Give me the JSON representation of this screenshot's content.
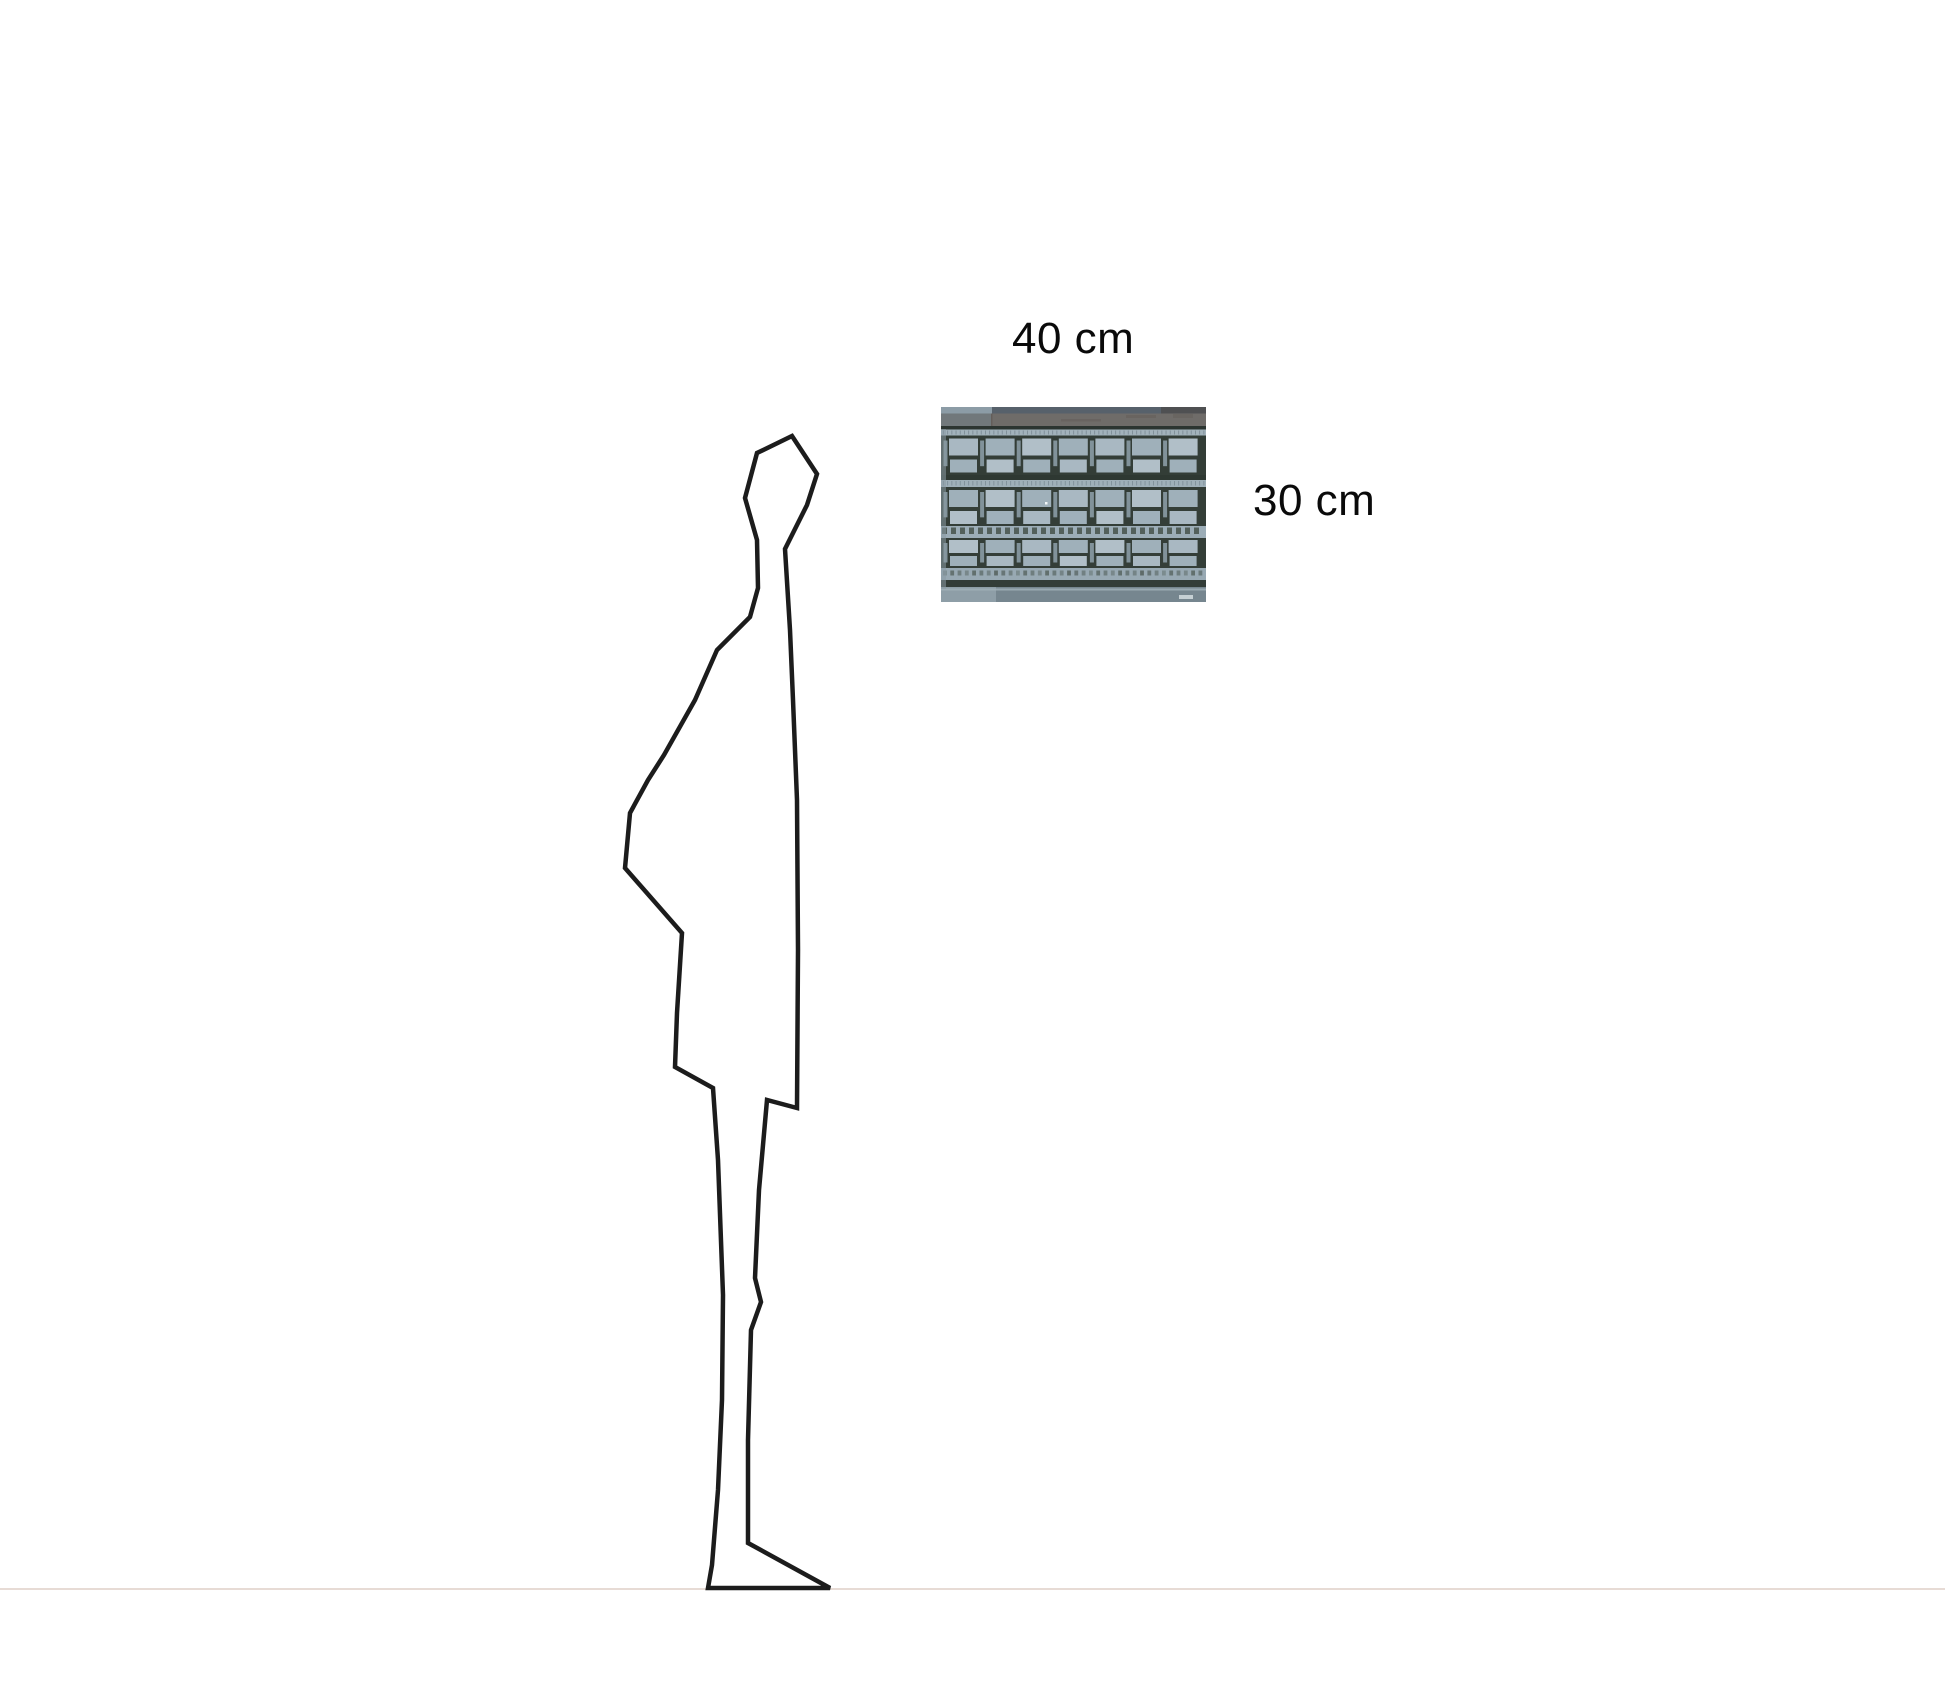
{
  "page": {
    "background_color": "#ffffff"
  },
  "scale_diagram": {
    "width_label": "40 cm",
    "height_label": "30 cm",
    "label_color": "#0a0a0a",
    "figure_outline_color": "#1c1c1c",
    "ground_line_color": "#e7dbd5",
    "artwork": {
      "alt": "aerial photograph of a modernist building facade with three rows of pale blue windows",
      "palette": {
        "facade_dark": "#333d37",
        "facade_dark2": "#343e38",
        "window_light": "#a9b8c2",
        "window_mid": "#9fb0ba",
        "window_bright": "#b1bfc8",
        "window_strip": "#8fa1ac",
        "cornice_light": "#a2b2bb",
        "cornice_light2": "#9fb0b9",
        "cornice_tick": "#6f7f88",
        "roof_gray": "#71787b",
        "roof_warm": "#6f6c69",
        "roof_streak": "#645e5a",
        "stripe_dark": "#2c3531",
        "stripe_dark2": "#2e3832",
        "stripe_dark3": "#333d38",
        "band_blue": "#9cadb7",
        "band_blue2": "#98a9b3",
        "band_dash": "#46524b",
        "base_bottom": "#76868f",
        "base_light": "#8e9ea7",
        "base_stripe": "#a3b2ba",
        "top_band": "#57616b",
        "top_left_light": "#8c9ca6",
        "top_right_dark": "#4f5052",
        "left_column": "#8a9aa4",
        "speck": "#f2f6f7",
        "signature": "#cfd8dc"
      }
    }
  }
}
